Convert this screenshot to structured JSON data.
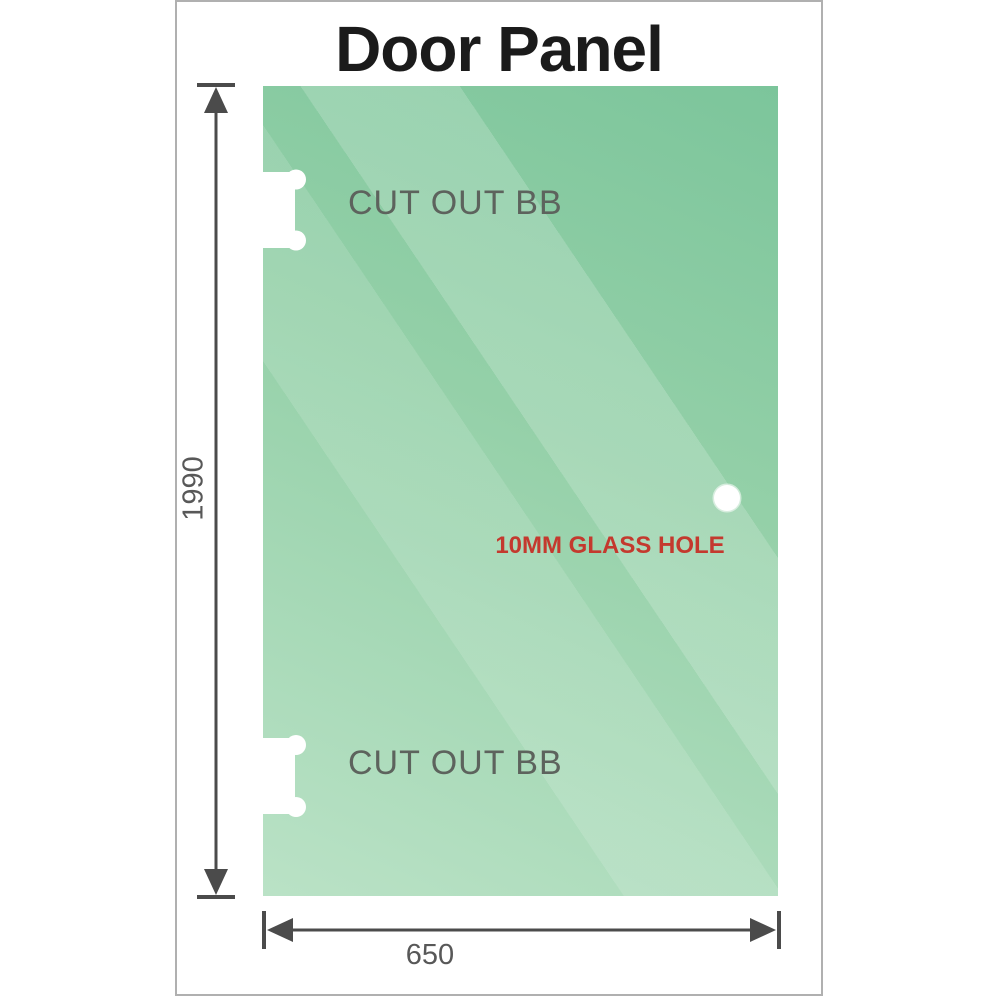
{
  "title": "Door Panel",
  "glass": {
    "cutout_top_label": "CUT OUT BB",
    "cutout_bottom_label": "CUT OUT BB",
    "hole_label": "10MM GLASS HOLE"
  },
  "dimensions": {
    "height": "1990",
    "width": "650"
  },
  "colors": {
    "glass_gradient_top": "#7cc59b",
    "glass_gradient_mid": "#94d0a8",
    "glass_gradient_bottom": "#bae2c6",
    "stripe_highlight": "rgba(255,255,255,0.18)",
    "cutout_fill": "#ffffff",
    "dimension_lines": "#4b4b4b",
    "dimension_text": "#585858",
    "cutout_text": "#5d635d",
    "hole_text": "#c4392e",
    "title_text": "#1b1b1b",
    "frame_border": "#b0b0b0"
  }
}
